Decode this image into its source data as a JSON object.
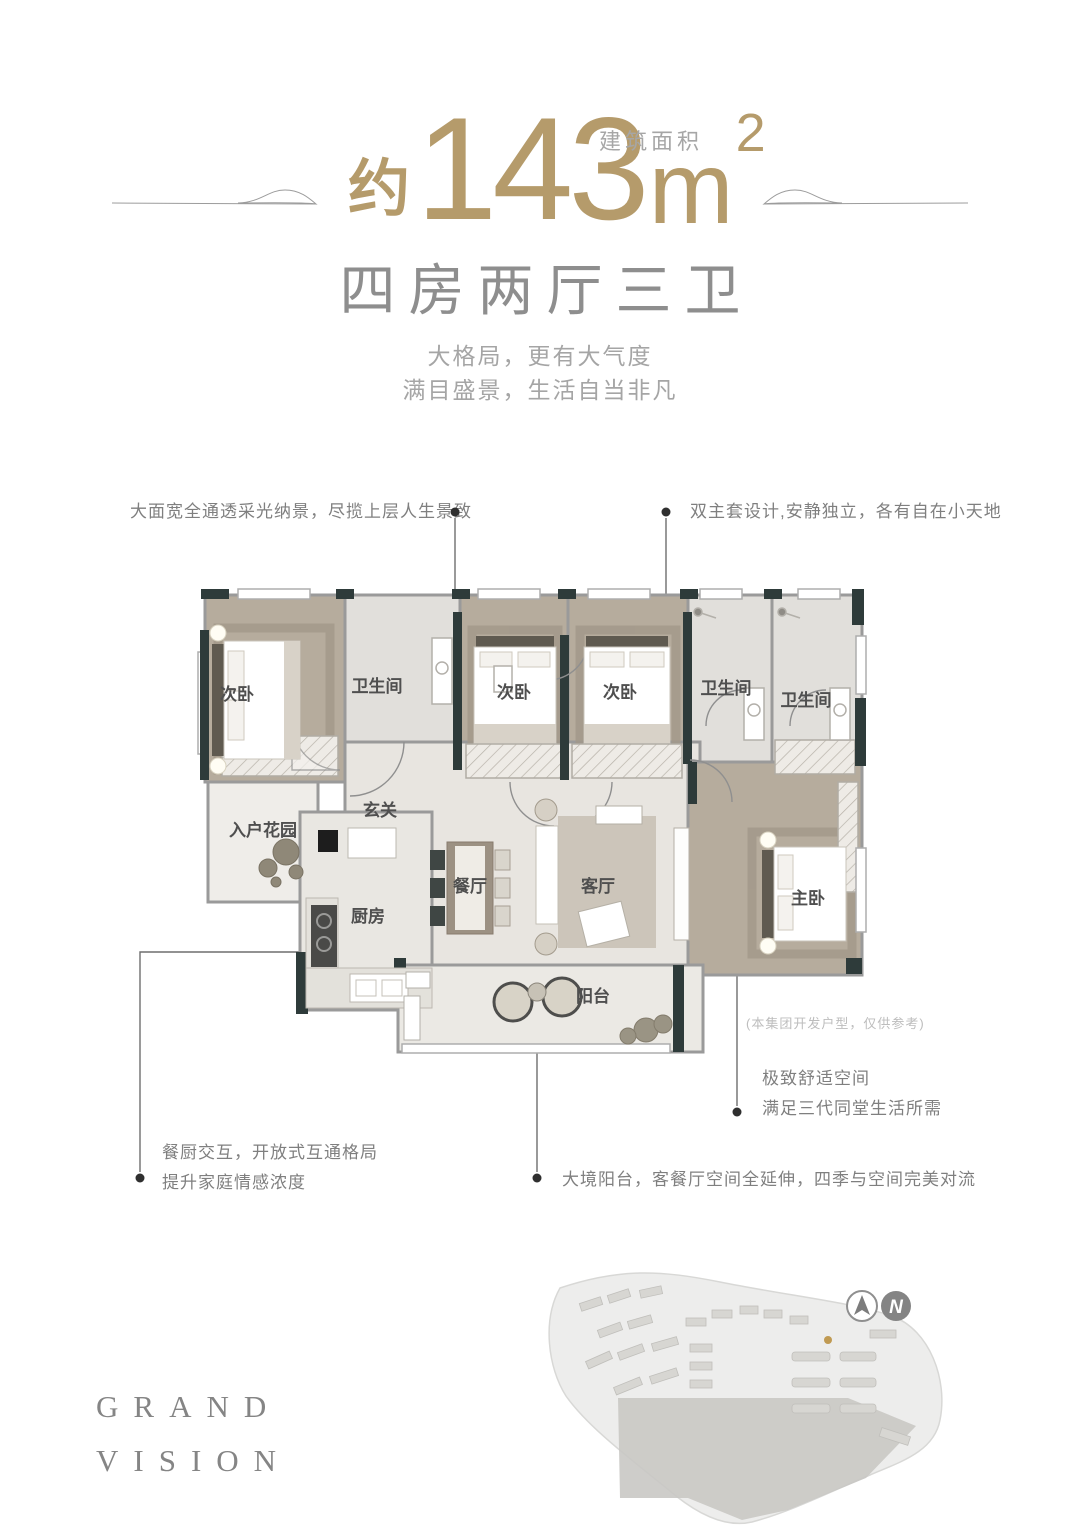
{
  "header": {
    "area_label": "建筑面积",
    "approx": "约",
    "area_number": "143",
    "area_unit": "m",
    "area_power": "2",
    "layout_title": "四房两厅三卫",
    "tagline1": "大格局，更有大气度",
    "tagline2": "满目盛景，生活自当非凡"
  },
  "callouts": {
    "top_left": "大面宽全通透采光纳景，尽揽上层人生景致",
    "top_right": "双主套设计,安静独立，各有自在小天地",
    "comfort1": "极致舒适空间",
    "comfort2": "满足三代同堂生活所需",
    "kitchen1": "餐厨交互，开放式互通格局",
    "kitchen2": "提升家庭情感浓度",
    "balcony": "大境阳台，客餐厅空间全延伸，四季与空间完美对流",
    "disclaimer": "(本集团开发户型，仅供参考)"
  },
  "rooms": {
    "bedroom_left": "次卧",
    "bath_left": "卫生间",
    "bedroom_mid": "次卧",
    "bedroom_right": "次卧",
    "bath_mid": "卫生间",
    "bath_right": "卫生间",
    "foyer": "玄关",
    "entry_garden": "入户花园",
    "kitchen": "厨房",
    "dining": "餐厅",
    "living": "客厅",
    "master": "主卧",
    "balcony": "阳台"
  },
  "brand": {
    "line1": "GRAND",
    "line2": "VISION"
  },
  "compass": {
    "label": "N"
  },
  "colors": {
    "gold": "#b59b6b",
    "wall_dark": "#2e3b3a",
    "text_gray": "#8c8c8c"
  }
}
